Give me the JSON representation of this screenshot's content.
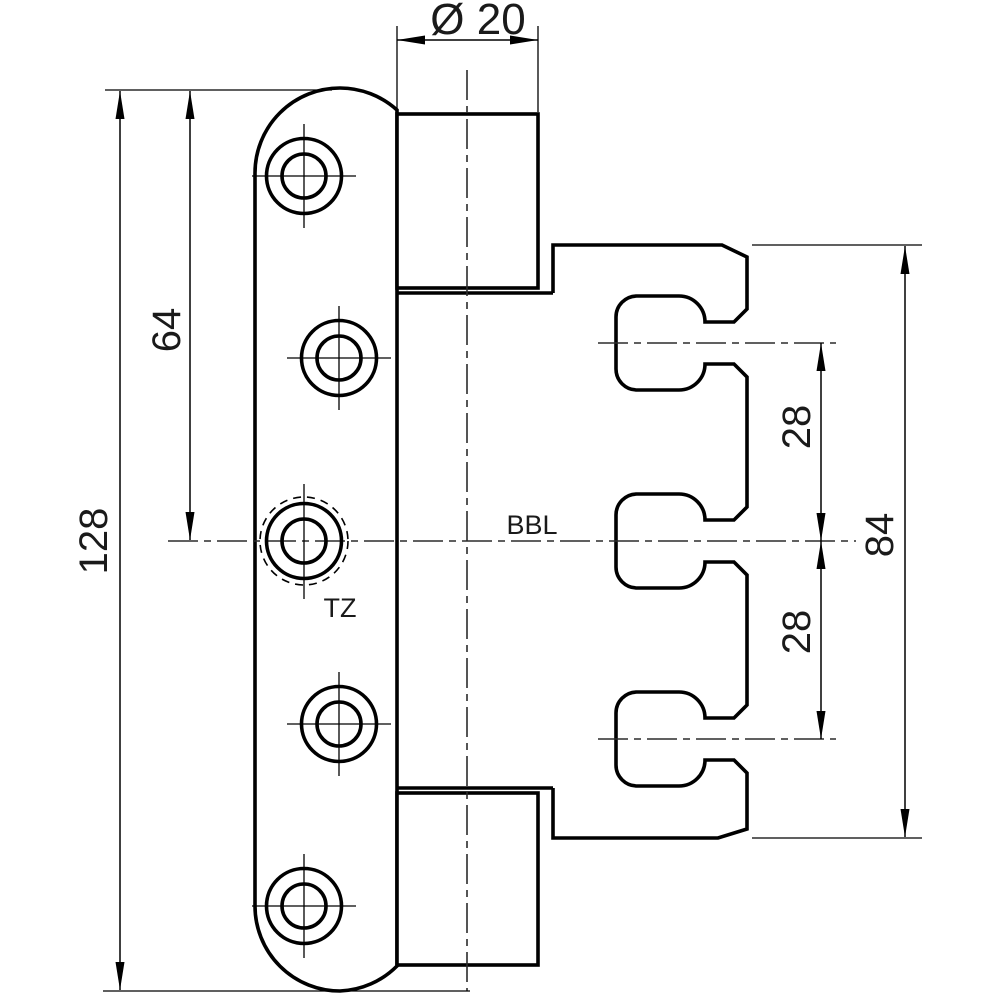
{
  "drawing": {
    "kind": "technical-drawing",
    "subject": "door hinge front view with door leaf, hinge barrel and frame fixing part",
    "colors": {
      "line": "#000000",
      "centerline": "#2b2b2b",
      "background": "#ffffff"
    },
    "dimension_labels": {
      "diameter": "Ø 20",
      "total_length": "128",
      "half_length": "64",
      "slot_pitch_upper": "28",
      "slot_pitch_lower": "28",
      "frame_height": "84"
    },
    "dimension_values": {
      "barrel_diameter_mm": 20,
      "leaf_length_mm": 128,
      "leaf_half_length_mm": 64,
      "slot_pitch_mm": 28,
      "frame_part_height_mm": 84
    },
    "annotations": {
      "reference_line": "BBL",
      "load_pin": "TZ"
    }
  }
}
